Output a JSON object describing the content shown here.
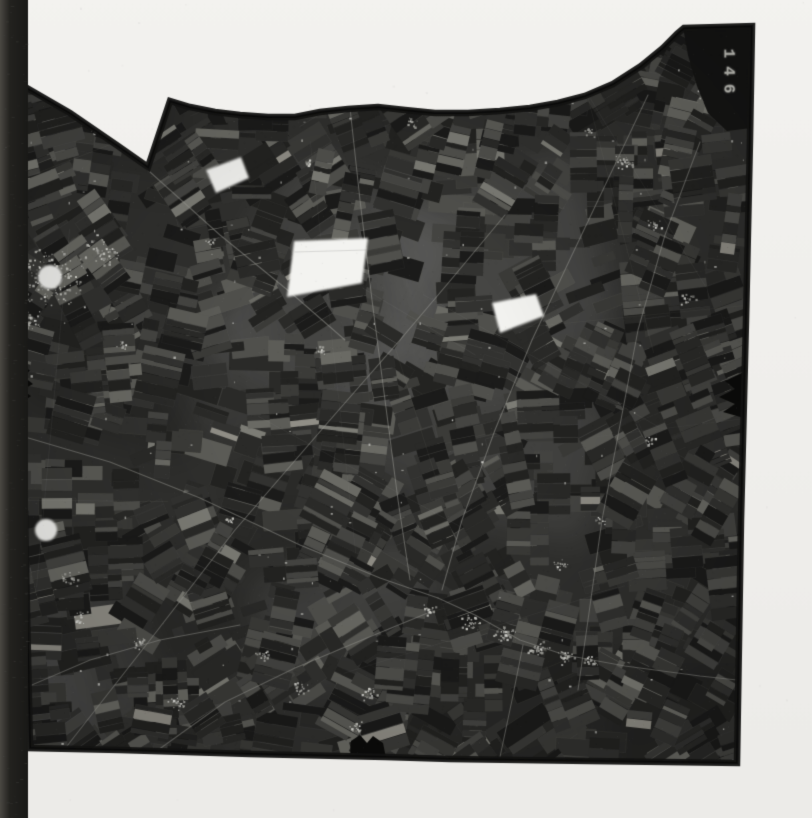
{
  "meta": {
    "description": "Scanned monochrome aerial survey photograph of agricultural field patchwork with villages, roads, cloud patches and film fiducial notches, frame number 146",
    "kind": "aerial-photo-scan"
  },
  "photo": {
    "label": "146",
    "label_color": "#a6a6a0",
    "background_top": "#f3f2ef",
    "background_bottom": "#ecebe8",
    "base_color": "#30302e",
    "border_color": "#131312",
    "film_strip": {
      "x": 0,
      "width": 28,
      "color_dark": "#23221f",
      "color_light": "#4a4843"
    },
    "outline": [
      [
        20,
        84
      ],
      [
        70,
        113
      ],
      [
        118,
        146
      ],
      [
        148,
        167
      ],
      [
        170,
        101
      ],
      [
        190,
        107
      ],
      [
        215,
        112
      ],
      [
        240,
        115
      ],
      [
        268,
        117
      ],
      [
        295,
        117
      ],
      [
        320,
        112
      ],
      [
        348,
        109
      ],
      [
        378,
        107
      ],
      [
        405,
        110
      ],
      [
        435,
        113
      ],
      [
        468,
        113
      ],
      [
        500,
        111
      ],
      [
        530,
        108
      ],
      [
        558,
        103
      ],
      [
        585,
        96
      ],
      [
        613,
        84
      ],
      [
        641,
        66
      ],
      [
        663,
        48
      ],
      [
        677,
        34
      ],
      [
        684,
        28
      ],
      [
        752,
        26
      ],
      [
        750,
        140
      ],
      [
        746,
        320
      ],
      [
        741,
        520
      ],
      [
        737,
        763
      ],
      [
        590,
        761
      ],
      [
        450,
        759
      ],
      [
        386,
        757
      ],
      [
        250,
        754
      ],
      [
        120,
        750
      ],
      [
        30,
        748
      ],
      [
        25,
        520
      ],
      [
        22,
        280
      ]
    ],
    "tab": {
      "color": "#151514",
      "polygon": [
        [
          683,
          27
        ],
        [
          752,
          26
        ],
        [
          751,
          128
        ],
        [
          727,
          131
        ],
        [
          708,
          113
        ],
        [
          697,
          86
        ],
        [
          688,
          55
        ]
      ]
    },
    "clouds": {
      "color": "#f3f3f0",
      "polygons": [
        [
          [
            206,
            170
          ],
          [
            241,
            157
          ],
          [
            249,
            178
          ],
          [
            216,
            193
          ]
        ],
        [
          [
            294,
            241
          ],
          [
            368,
            238
          ],
          [
            362,
            283
          ],
          [
            287,
            297
          ]
        ],
        [
          [
            492,
            303
          ],
          [
            536,
            294
          ],
          [
            544,
            316
          ],
          [
            500,
            333
          ]
        ]
      ],
      "circles": [
        {
          "cx": 50,
          "cy": 277,
          "r": 12
        },
        {
          "cx": 46,
          "cy": 530,
          "r": 11
        }
      ]
    },
    "notches": {
      "color": "#0b0b0a",
      "polygons": [
        [
          [
            12,
            366
          ],
          [
            30,
            370
          ],
          [
            24,
            377
          ],
          [
            33,
            384
          ],
          [
            22,
            390
          ],
          [
            31,
            396
          ],
          [
            24,
            401
          ],
          [
            12,
            404
          ]
        ],
        [
          [
            744,
            372
          ],
          [
            725,
            381
          ],
          [
            735,
            389
          ],
          [
            719,
            397
          ],
          [
            735,
            404
          ],
          [
            723,
            412
          ],
          [
            744,
            418
          ]
        ],
        [
          [
            350,
            758
          ],
          [
            351,
            741
          ],
          [
            360,
            735
          ],
          [
            367,
            743
          ],
          [
            373,
            736
          ],
          [
            383,
            743
          ],
          [
            386,
            758
          ]
        ]
      ]
    },
    "roads": {
      "color": "rgba(158,158,152,0.5)",
      "paths": [
        [
          [
            60,
            755
          ],
          [
            150,
            640
          ],
          [
            235,
            530
          ],
          [
            330,
            420
          ],
          [
            400,
            340
          ],
          [
            455,
            275
          ],
          [
            505,
            215
          ]
        ],
        [
          [
            438,
            598
          ],
          [
            475,
            615
          ],
          [
            520,
            640
          ],
          [
            565,
            655
          ],
          [
            625,
            666
          ],
          [
            700,
            676
          ],
          [
            737,
            680
          ]
        ],
        [
          [
            523,
            645
          ],
          [
            512,
            700
          ],
          [
            500,
            757
          ]
        ],
        [
          [
            25,
            437
          ],
          [
            110,
            462
          ],
          [
            200,
            498
          ],
          [
            300,
            545
          ],
          [
            380,
            578
          ],
          [
            438,
            598
          ]
        ],
        [
          [
            648,
            95
          ],
          [
            610,
            175
          ],
          [
            572,
            255
          ],
          [
            532,
            340
          ],
          [
            495,
            430
          ],
          [
            462,
            520
          ],
          [
            442,
            590
          ]
        ],
        [
          [
            88,
            118
          ],
          [
            150,
            172
          ],
          [
            220,
            235
          ],
          [
            290,
            292
          ],
          [
            345,
            340
          ]
        ],
        [
          [
            700,
            142
          ],
          [
            665,
            235
          ],
          [
            638,
            330
          ],
          [
            620,
            425
          ],
          [
            602,
            520
          ],
          [
            588,
            620
          ],
          [
            578,
            690
          ]
        ],
        [
          [
            158,
            750
          ],
          [
            225,
            702
          ],
          [
            295,
            668
          ],
          [
            362,
            640
          ],
          [
            430,
            612
          ]
        ],
        [
          [
            20,
            690
          ],
          [
            90,
            660
          ],
          [
            160,
            640
          ],
          [
            240,
            625
          ]
        ],
        [
          [
            350,
            108
          ],
          [
            360,
            200
          ],
          [
            372,
            300
          ],
          [
            385,
            400
          ],
          [
            398,
            500
          ],
          [
            410,
            580
          ]
        ]
      ]
    },
    "villages": [
      [
        50,
        277,
        42,
        150
      ],
      [
        100,
        250,
        20,
        45
      ],
      [
        30,
        320,
        14,
        30
      ],
      [
        70,
        578,
        10,
        22
      ],
      [
        80,
        616,
        9,
        18
      ],
      [
        140,
        642,
        9,
        18
      ],
      [
        176,
        704,
        11,
        24
      ],
      [
        262,
        655,
        8,
        16
      ],
      [
        300,
        688,
        9,
        18
      ],
      [
        368,
        693,
        10,
        20
      ],
      [
        355,
        727,
        8,
        14
      ],
      [
        430,
        610,
        10,
        22
      ],
      [
        470,
        622,
        12,
        28
      ],
      [
        505,
        634,
        12,
        30
      ],
      [
        538,
        648,
        12,
        32
      ],
      [
        565,
        657,
        10,
        24
      ],
      [
        590,
        662,
        9,
        18
      ],
      [
        560,
        565,
        9,
        18
      ],
      [
        600,
        520,
        7,
        12
      ],
      [
        625,
        162,
        12,
        26
      ],
      [
        590,
        130,
        8,
        14
      ],
      [
        655,
        225,
        8,
        14
      ],
      [
        688,
        298,
        8,
        12
      ],
      [
        705,
        95,
        10,
        20
      ],
      [
        648,
        440,
        7,
        12
      ],
      [
        230,
        520,
        6,
        10
      ],
      [
        320,
        350,
        7,
        12
      ],
      [
        120,
        345,
        6,
        10
      ],
      [
        412,
        122,
        7,
        12
      ],
      [
        310,
        162,
        6,
        10
      ],
      [
        210,
        240,
        6,
        10
      ],
      [
        95,
        130,
        6,
        10
      ]
    ],
    "texture": {
      "seed": 146,
      "singles": 620,
      "runs": 560,
      "lines": 16,
      "patches": 16,
      "farm_specks": 120,
      "grain": 3200,
      "palette": [
        "#1b1b1a",
        "#232321",
        "#2a2a28",
        "#323230",
        "#3b3b38",
        "#454542",
        "#50504c",
        "#5c5c57",
        "#6a6a64",
        "#7c7c75",
        "#908e86"
      ],
      "weights": [
        2.6,
        3.0,
        3.0,
        2.6,
        2.1,
        1.6,
        1.2,
        0.8,
        0.5,
        0.25,
        0.12
      ]
    }
  }
}
